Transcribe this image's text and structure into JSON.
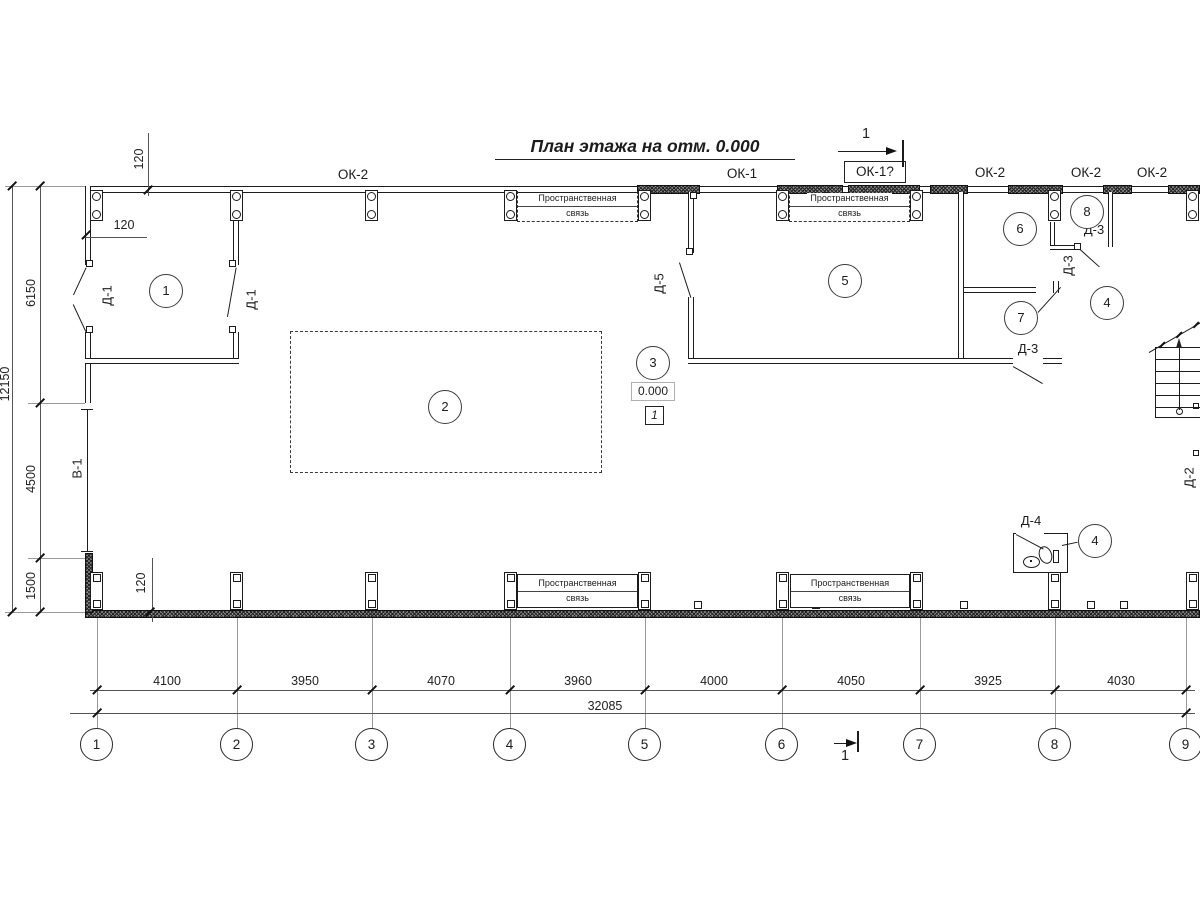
{
  "title": "План этажа на отм. 0.000",
  "labels": {
    "ok2": "ОК-2",
    "ok1": "ОК-1",
    "ok1q": "ОК-1?",
    "d1": "Д-1",
    "d2": "Д-2",
    "d3": "Д-3",
    "d4": "Д-4",
    "d5": "Д-5",
    "v1": "В-1"
  },
  "brace": {
    "line1": "Пространственная",
    "line2": "связь"
  },
  "elevation": {
    "value": "0.000",
    "node": "1"
  },
  "section": {
    "label": "1"
  },
  "callouts": {
    "wall": "120"
  },
  "rooms": [
    "1",
    "2",
    "3",
    "4",
    "5",
    "6",
    "7",
    "8"
  ],
  "grid": {
    "labels": [
      "1",
      "2",
      "3",
      "4",
      "5",
      "6",
      "7",
      "8",
      "9"
    ]
  },
  "dims_bottom": {
    "values": [
      "4100",
      "3950",
      "4070",
      "3960",
      "4000",
      "4050",
      "3925",
      "4030"
    ],
    "total": "32085"
  },
  "dims_left": {
    "values": [
      "6150",
      "4500",
      "1500"
    ],
    "total": "12150"
  }
}
